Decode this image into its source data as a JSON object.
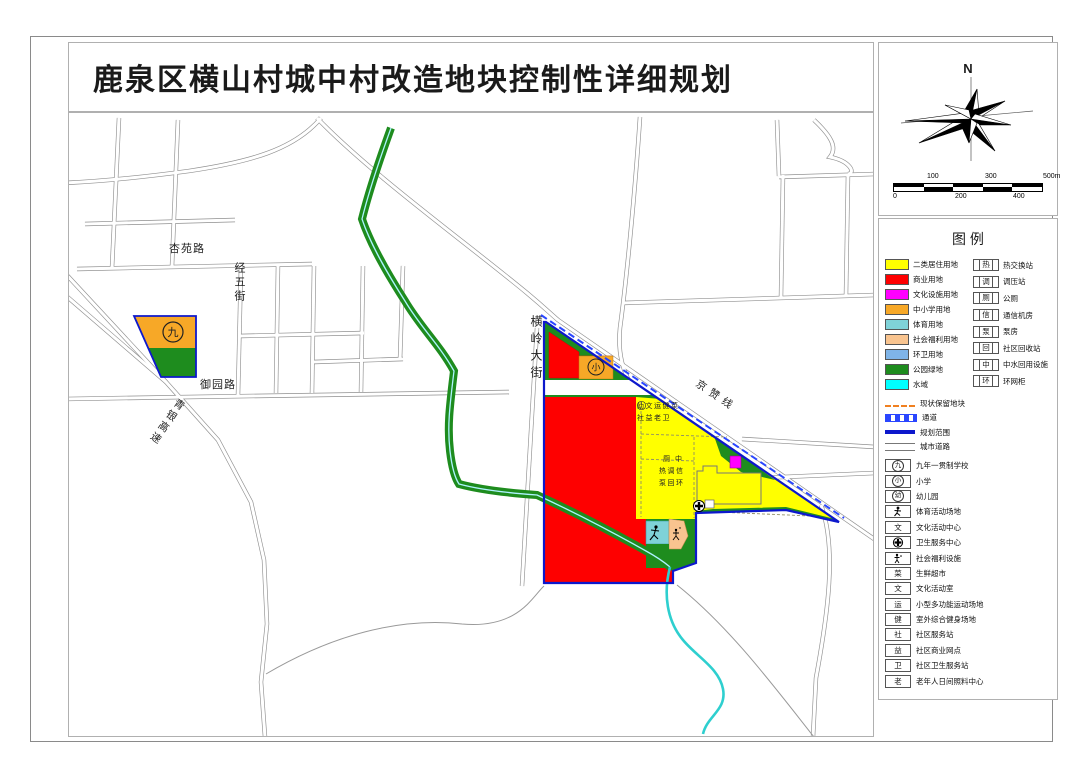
{
  "title": "鹿泉区横山村城中村改造地块控制性详细规划",
  "compass": {
    "north_label": "N"
  },
  "scalebar": {
    "top_labels": [
      "100",
      "300",
      "500m"
    ],
    "bottom_labels": [
      "0",
      "200",
      "400"
    ]
  },
  "legend": {
    "header": "图  例",
    "landuse": [
      {
        "label": "二类居住用地",
        "color": "#ffff00"
      },
      {
        "label": "商业用地",
        "color": "#fe0000"
      },
      {
        "label": "文化设施用地",
        "color": "#ff00ff"
      },
      {
        "label": "中小学用地",
        "color": "#f7a827"
      },
      {
        "label": "体育用地",
        "color": "#7fd2d8"
      },
      {
        "label": "社会福利用地",
        "color": "#f9c48f"
      },
      {
        "label": "环卫用地",
        "color": "#7fb4e8"
      },
      {
        "label": "公园绿地",
        "color": "#1e8c1e"
      },
      {
        "label": "水域",
        "color": "#00ffff"
      }
    ],
    "utilities": [
      {
        "sym": "热",
        "label": "热交换站"
      },
      {
        "sym": "调",
        "label": "调压站"
      },
      {
        "sym": "厕",
        "label": "公厕"
      },
      {
        "sym": "信",
        "label": "通信机房"
      },
      {
        "sym": "泵",
        "label": "泵房"
      },
      {
        "sym": "回",
        "label": "社区回收站"
      },
      {
        "sym": "中",
        "label": "中水回用设施"
      },
      {
        "sym": "环",
        "label": "环网柜"
      }
    ],
    "lines": [
      {
        "kind": "dash-orange",
        "label": "现状保留地块"
      },
      {
        "kind": "dash-blue",
        "label": "通道"
      },
      {
        "kind": "solid-blue",
        "label": "规划范围"
      },
      {
        "kind": "road",
        "label": "城市道路"
      }
    ],
    "facilities": [
      {
        "sym": "九",
        "kind": "circle",
        "label": "九年一贯制学校"
      },
      {
        "sym": "小",
        "kind": "circle",
        "label": "小学"
      },
      {
        "sym": "幼",
        "kind": "circle",
        "label": "幼儿园"
      },
      {
        "sym": "",
        "kind": "figure",
        "label": "体育活动场地"
      },
      {
        "sym": "文",
        "kind": "box",
        "label": "文化活动中心"
      },
      {
        "sym": "",
        "kind": "cross",
        "label": "卫生服务中心"
      },
      {
        "sym": "",
        "kind": "person",
        "label": "社会福利设施"
      },
      {
        "sym": "菜",
        "kind": "box",
        "label": "生鲜超市"
      },
      {
        "sym": "文",
        "kind": "box",
        "label": "文化活动室"
      },
      {
        "sym": "运",
        "kind": "box",
        "label": "小型多功能运动场地"
      },
      {
        "sym": "健",
        "kind": "box",
        "label": "室外综合健身场地"
      },
      {
        "sym": "社",
        "kind": "box",
        "label": "社区服务站"
      },
      {
        "sym": "益",
        "kind": "box",
        "label": "社区商业网点"
      },
      {
        "sym": "卫",
        "kind": "box",
        "label": "社区卫生服务站"
      },
      {
        "sym": "老",
        "kind": "box",
        "label": "老年人日间照料中心"
      }
    ]
  },
  "map": {
    "roads": {
      "xingyuan": "杏苑路",
      "jingwu": "经五街",
      "yuyuan": "御园路",
      "qingyin": "青银高速",
      "hengling": "横岭大街",
      "jingzan": "京赞线"
    },
    "symbols": {
      "nine": "九",
      "primary": "小"
    },
    "annotations": {
      "a1": "幼文运健菜",
      "a2": "社益老卫",
      "b1": "厕 中",
      "b2": "热调信",
      "b3": "泵回环"
    }
  },
  "colors": {
    "boundary": "#0d18cc",
    "channel_dash": "#2a46ff",
    "green": "#1e8c1e",
    "water": "#2ecfcf",
    "retain_dash": "#f08020"
  }
}
